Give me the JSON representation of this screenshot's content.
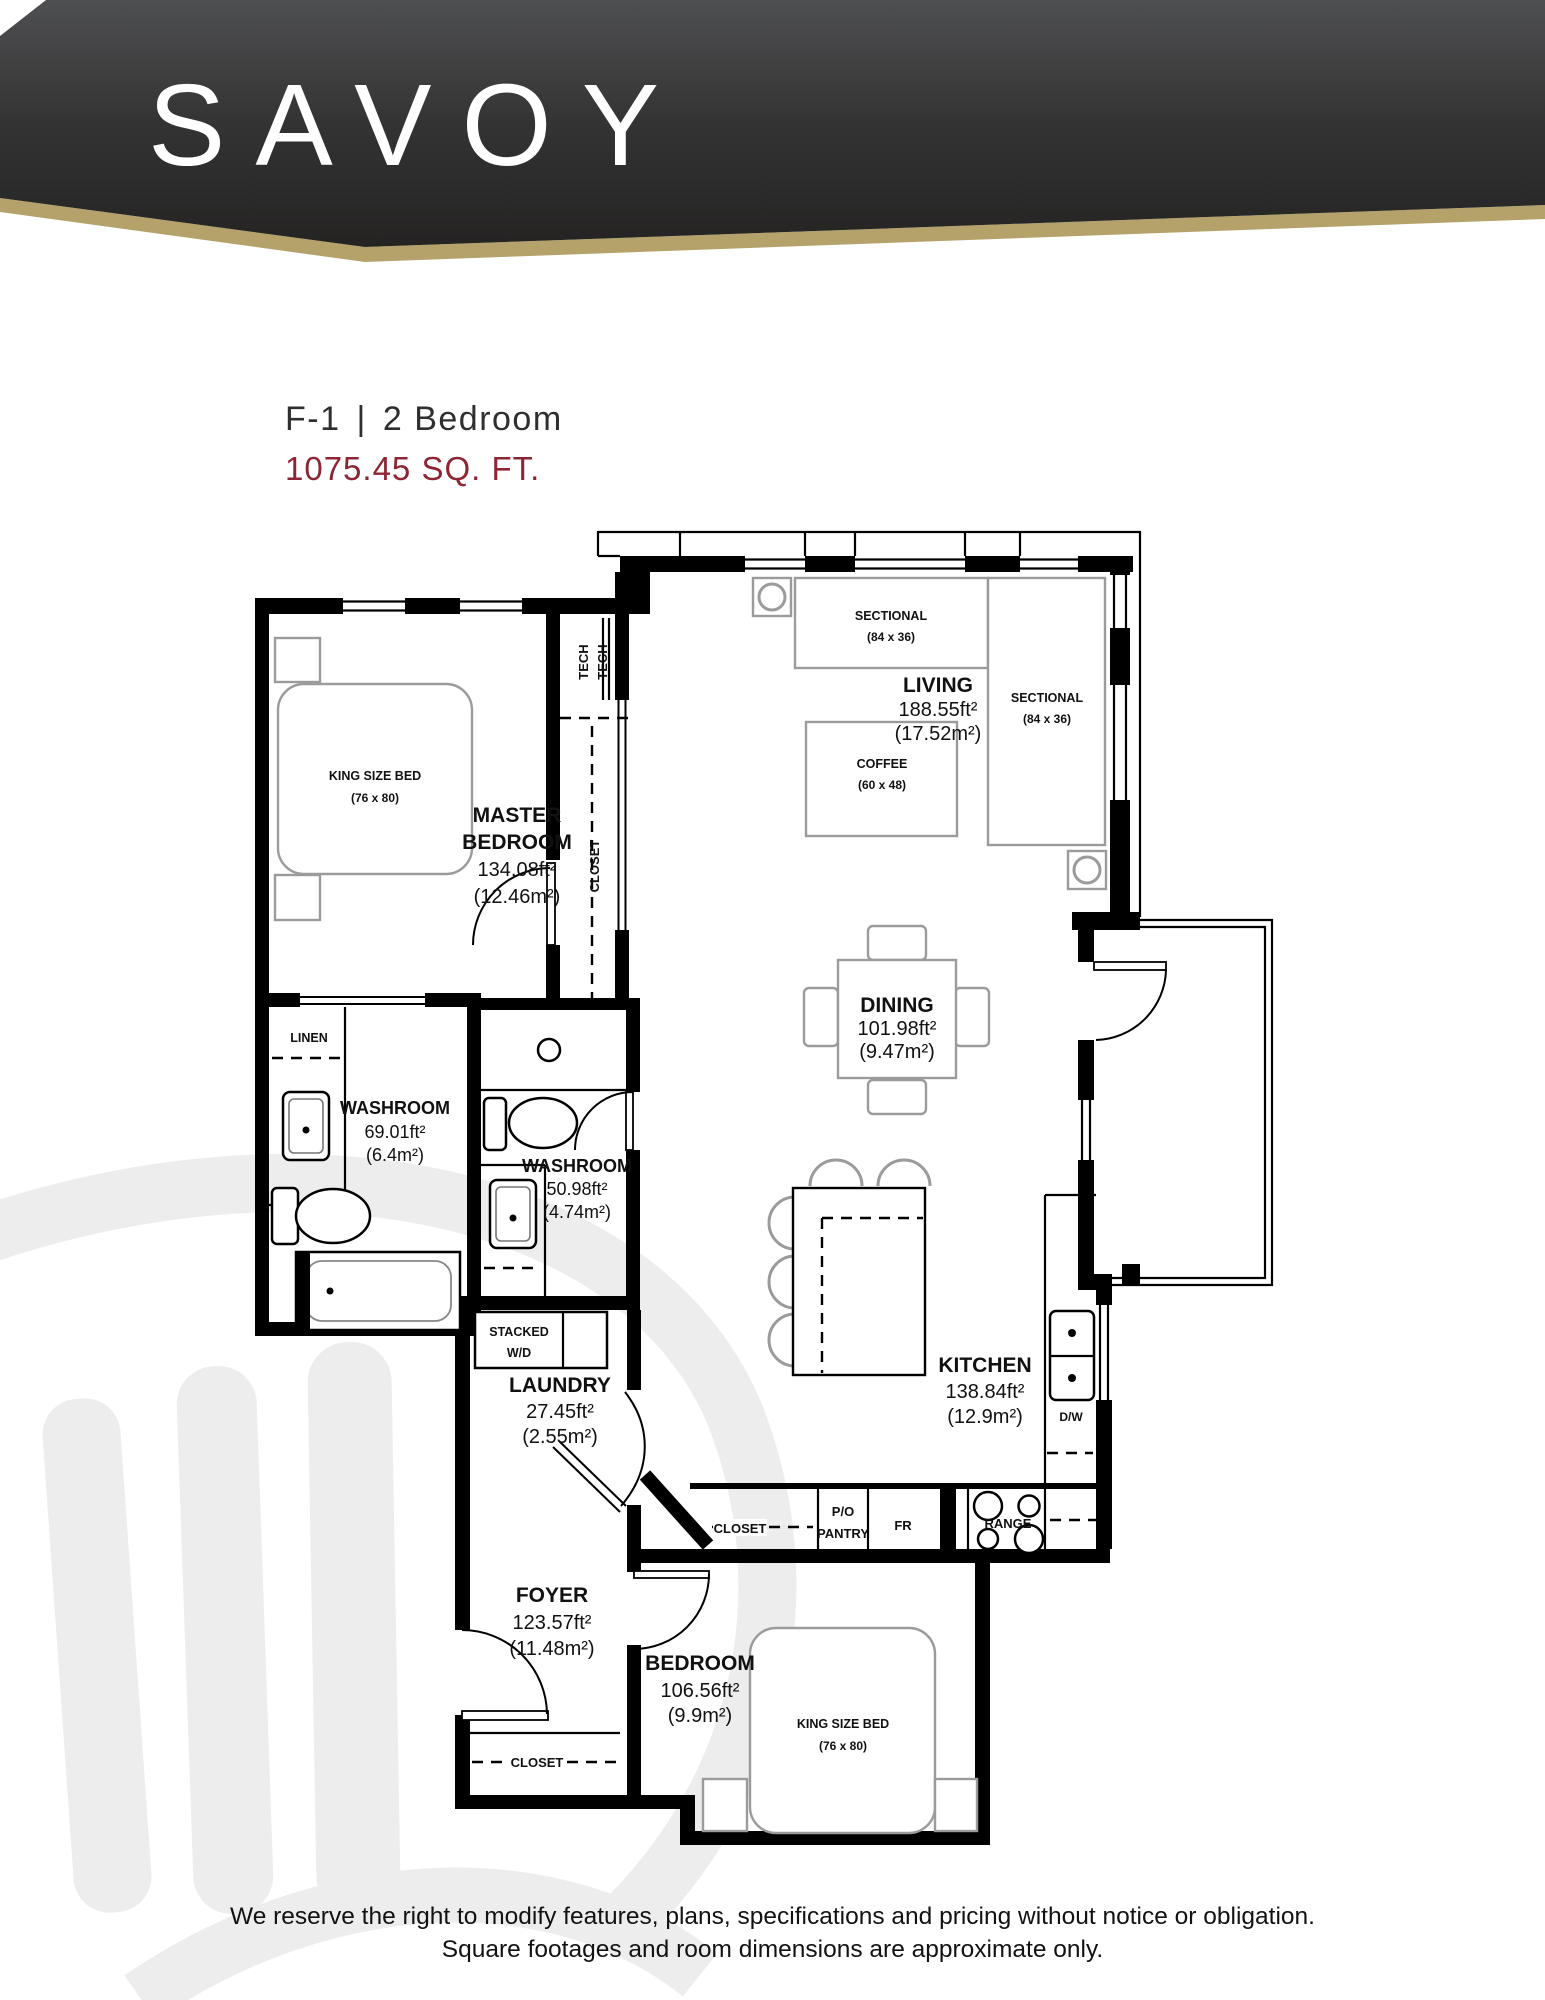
{
  "header": {
    "brand": "SAVOY"
  },
  "title": {
    "unit": "F-1",
    "divider": "|",
    "type": "2 Bedroom",
    "area": "1075.45 SQ. FT."
  },
  "rooms": {
    "living": {
      "name": "LIVING",
      "ft": "188.55ft²",
      "m": "(17.52m²)"
    },
    "master": {
      "line1": "MASTER",
      "line2": "BEDROOM",
      "ft": "134.08ft²",
      "m": "(12.46m²)"
    },
    "dining": {
      "name": "DINING",
      "ft": "101.98ft²",
      "m": "(9.47m²)"
    },
    "washroom1": {
      "name": "WASHROOM",
      "ft": "69.01ft²",
      "m": "(6.4m²)"
    },
    "washroom2": {
      "name": "WASHROOM",
      "ft": "50.98ft²",
      "m": "(4.74m²)"
    },
    "laundry": {
      "name": "LAUNDRY",
      "ft": "27.45ft²",
      "m": "(2.55m²)"
    },
    "kitchen": {
      "name": "KITCHEN",
      "ft": "138.84ft²",
      "m": "(12.9m²)"
    },
    "foyer": {
      "name": "FOYER",
      "ft": "123.57ft²",
      "m": "(11.48m²)"
    },
    "bedroom2": {
      "name": "BEDROOM",
      "ft": "106.56ft²",
      "m": "(9.9m²)"
    }
  },
  "furniture": {
    "king_bed": "KING SIZE BED",
    "king_bed_dim": "(76 x 80)",
    "sectional": "SECTIONAL",
    "sectional_dim": "(84 x 36)",
    "coffee": "COFFEE",
    "coffee_dim": "(60 x 48)"
  },
  "labels": {
    "tech": "TECH",
    "closet": "CLOSET",
    "linen": "LINEN",
    "stacked": "STACKED",
    "wd": "W/D",
    "po": "P/O",
    "pantry": "PANTRY",
    "fridge": "FR",
    "range": "RANGE",
    "dw": "D/W"
  },
  "footer": {
    "line1": "We reserve the right to modify features, plans, specifications and pricing without notice or obligation.",
    "line2": "Square footages and room dimensions are approximate only."
  },
  "colors": {
    "maroon": "#8e2534",
    "gold": "#b5a26b",
    "header_top": "#4e4f51",
    "header_bottom": "#242322",
    "plan_line": "#000000",
    "furniture_line": "#9b9b9b",
    "watermark": "#ededed"
  }
}
